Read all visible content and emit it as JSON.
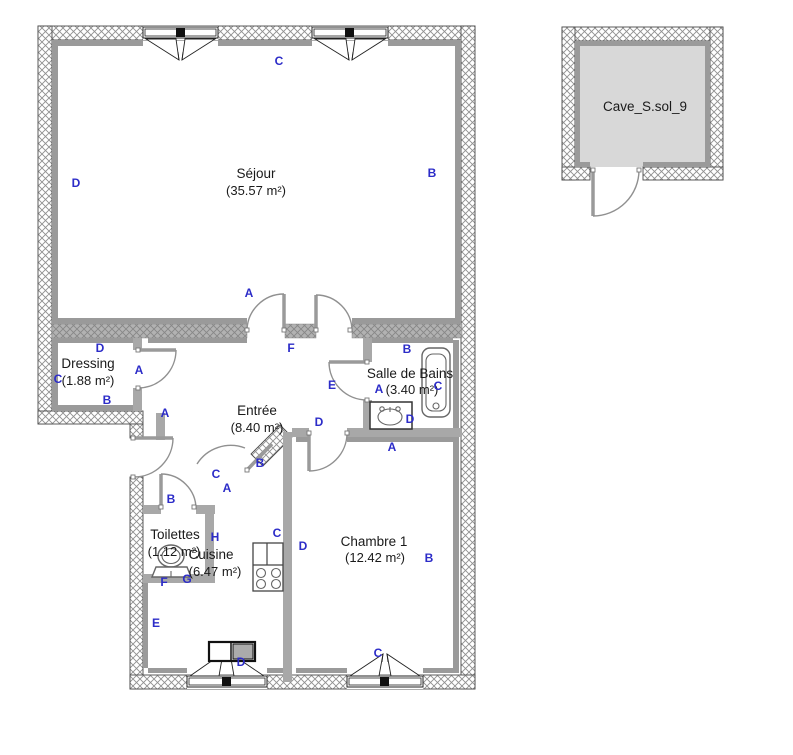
{
  "title": "Floor plan",
  "colors": {
    "wall_label_blue": "#2c2cc8",
    "interior_wall_gray": "#a8a8a8",
    "inner_line_gray": "#9a9a9a",
    "cave_fill_gray": "#d8d8d8",
    "room_text_black": "#1a1a1a",
    "door_arc_gray": "#909090"
  },
  "icons": [
    "window-icon",
    "door-arc-icon",
    "bathtub-icon",
    "washbasin-icon",
    "toilet-icon",
    "sink-unit-icon",
    "stove-icon"
  ],
  "floorplan": {
    "rooms": {
      "sejour": {
        "name": "Séjour",
        "area": "(35.57 m²)"
      },
      "dressing": {
        "name": "Dressing",
        "area": "(1.88 m²)"
      },
      "entree": {
        "name": "Entrée",
        "area": "(8.40 m²)"
      },
      "sdb": {
        "name": "Salle de Bains",
        "area": "(3.40 m²)"
      },
      "toilettes": {
        "name": "Toilettes",
        "area": "(1.12 m²)"
      },
      "cuisine": {
        "name": "Cuisine",
        "area": "(6.47 m²)"
      },
      "chambre": {
        "name": "Chambre 1",
        "area": "(12.42 m²)"
      },
      "cave": {
        "name": "Cave_S.sol_9"
      }
    },
    "wall_labels": [
      {
        "text": "C",
        "x": 279,
        "y": 65
      },
      {
        "text": "D",
        "x": 76,
        "y": 187
      },
      {
        "text": "B",
        "x": 432,
        "y": 177
      },
      {
        "text": "A",
        "x": 249,
        "y": 297
      },
      {
        "text": "F",
        "x": 291,
        "y": 352
      },
      {
        "text": "D",
        "x": 100,
        "y": 352
      },
      {
        "text": "C",
        "x": 58,
        "y": 383
      },
      {
        "text": "B",
        "x": 107,
        "y": 404
      },
      {
        "text": "A",
        "x": 139,
        "y": 374
      },
      {
        "text": "A",
        "x": 165,
        "y": 417
      },
      {
        "text": "E",
        "x": 332,
        "y": 389
      },
      {
        "text": "B",
        "x": 407,
        "y": 353
      },
      {
        "text": "A",
        "x": 379,
        "y": 393
      },
      {
        "text": "C",
        "x": 438,
        "y": 390
      },
      {
        "text": "D",
        "x": 410,
        "y": 423
      },
      {
        "text": "A",
        "x": 392,
        "y": 451
      },
      {
        "text": "D",
        "x": 319,
        "y": 426
      },
      {
        "text": "B",
        "x": 260,
        "y": 467
      },
      {
        "text": "C",
        "x": 216,
        "y": 478
      },
      {
        "text": "A",
        "x": 227,
        "y": 492
      },
      {
        "text": "B",
        "x": 171,
        "y": 503
      },
      {
        "text": "H",
        "x": 215,
        "y": 541
      },
      {
        "text": "C",
        "x": 277,
        "y": 537
      },
      {
        "text": "D",
        "x": 303,
        "y": 550
      },
      {
        "text": "F",
        "x": 164,
        "y": 586
      },
      {
        "text": "G",
        "x": 187,
        "y": 583
      },
      {
        "text": "E",
        "x": 156,
        "y": 627
      },
      {
        "text": "D",
        "x": 241,
        "y": 666
      },
      {
        "text": "B",
        "x": 429,
        "y": 562
      },
      {
        "text": "C",
        "x": 378,
        "y": 657
      }
    ]
  }
}
